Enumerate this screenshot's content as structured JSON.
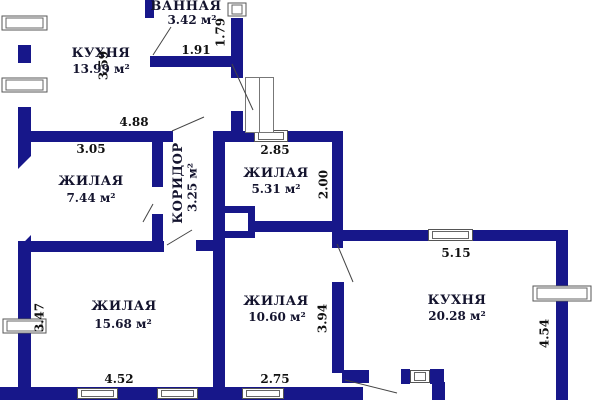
{
  "rooms": {
    "kitchen_top_left": {
      "name": "КУХНЯ",
      "area": "13.99 м²"
    },
    "bathroom": {
      "name": "ВАННАЯ",
      "area": "3.42 м²"
    },
    "living_left": {
      "name": "ЖИЛАЯ",
      "area": "7.44 м²"
    },
    "corridor": {
      "name": "КОРИДОР",
      "area": "3.25 м²"
    },
    "living_center": {
      "name": "ЖИЛАЯ",
      "area": "5.31 м²"
    },
    "living_bottom_left": {
      "name": "ЖИЛАЯ",
      "area": "15.68 м²"
    },
    "living_bottom_center": {
      "name": "ЖИЛАЯ",
      "area": "10.60 м²"
    },
    "kitchen_bottom_right": {
      "name": "КУХНЯ",
      "area": "20.28 м²"
    }
  },
  "dimensions": {
    "left_wall_top": "3.59",
    "bathroom_height": "1.79",
    "bathroom_width": "1.91",
    "hall_width": "4.88",
    "living_left_width": "3.05",
    "living_center_width": "2.85",
    "living_center_height": "2.00",
    "kitchen_top_width": "5.15",
    "kitchen_left_height": "3.94",
    "kitchen_right_height": "4.54",
    "living_bottom_left_height": "3.47",
    "living_bottom_left_width": "4.52",
    "living_bottom_center_width": "2.75"
  },
  "colors": {
    "wall": "#17178A",
    "room_text": "#14142E",
    "dimension_text": "#111111",
    "thin_line": "#555555",
    "background": "#FFFFFF"
  }
}
